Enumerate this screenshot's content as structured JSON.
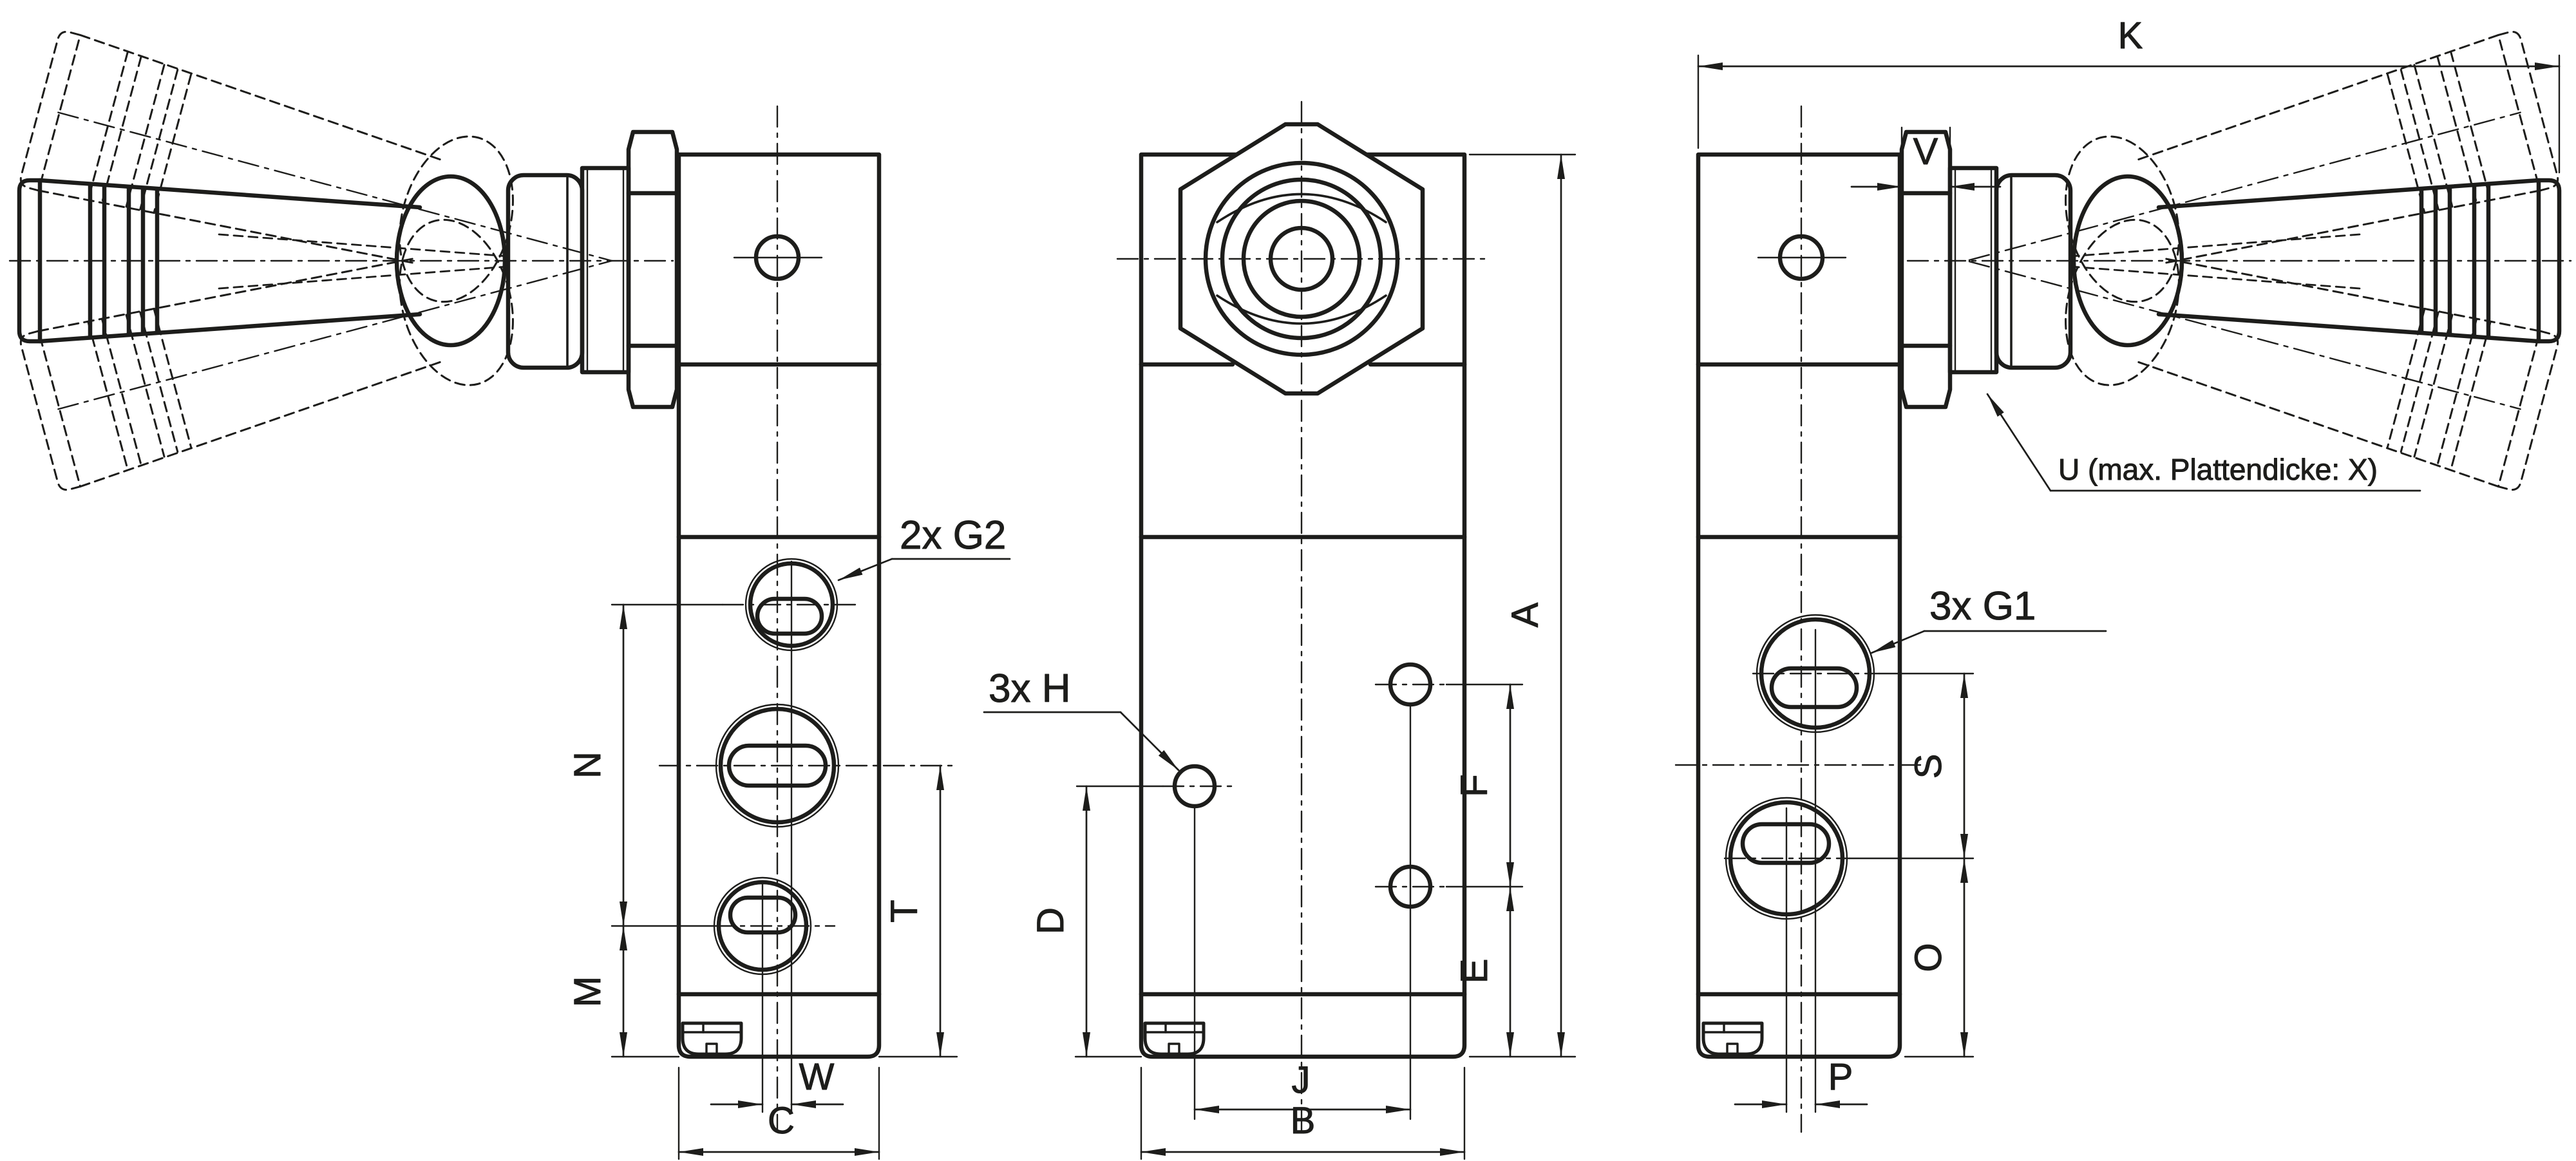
{
  "colors": {
    "background": "#ffffff",
    "ink": "#1d1d1b"
  },
  "annotations": {
    "ports_g2": "2x G2",
    "ports_g1": "3x G1",
    "holes_h": "3x H",
    "panel_note": "U (max. Plattendicke: X)"
  },
  "dims": {
    "N": "N",
    "M": "M",
    "T": "T",
    "W": "W",
    "C": "C",
    "A": "A",
    "B": "B",
    "D": "D",
    "E": "E",
    "F": "F",
    "J": "J",
    "K": "K",
    "V": "V",
    "S": "S",
    "O": "O",
    "P": "P"
  }
}
